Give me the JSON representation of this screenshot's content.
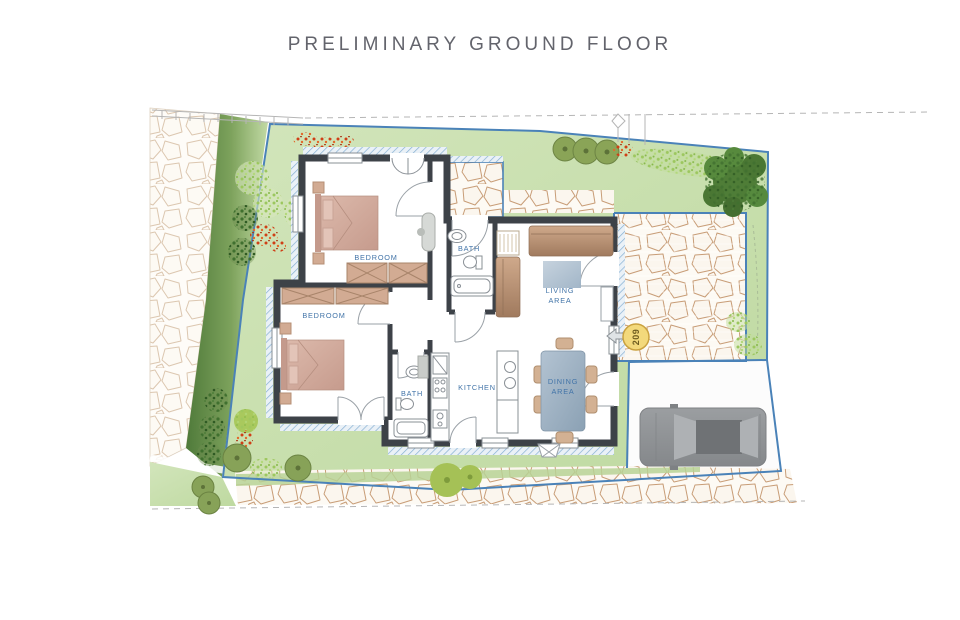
{
  "title": "PRELIMINARY GROUND FLOOR",
  "rooms": {
    "bedroom1": "BEDROOM",
    "bedroom2": "BEDROOM",
    "bath1": "BATH",
    "bath2": "BATH",
    "kitchen": "KITCHEN",
    "living1": "LIVING",
    "living2": "AREA",
    "dining1": "DINING",
    "dining2": "AREA"
  },
  "unit_number": "209",
  "colors": {
    "title_text": "#63646c",
    "room_label": "#4274a8",
    "plot_boundary": "#4a82b8",
    "wall": "#3d4248",
    "lawn": "#c8dfa8",
    "unit_badge": "#f3d97b",
    "furniture_tan": "#d2ab93",
    "table_blue_gray": "#9db2c5"
  },
  "site_features": {
    "car": "car-top-view",
    "trees": "tree-canopy",
    "paving": "stone-crazy-paving",
    "hedge": "hedge-band",
    "road_edge": "dashed-road-line"
  }
}
